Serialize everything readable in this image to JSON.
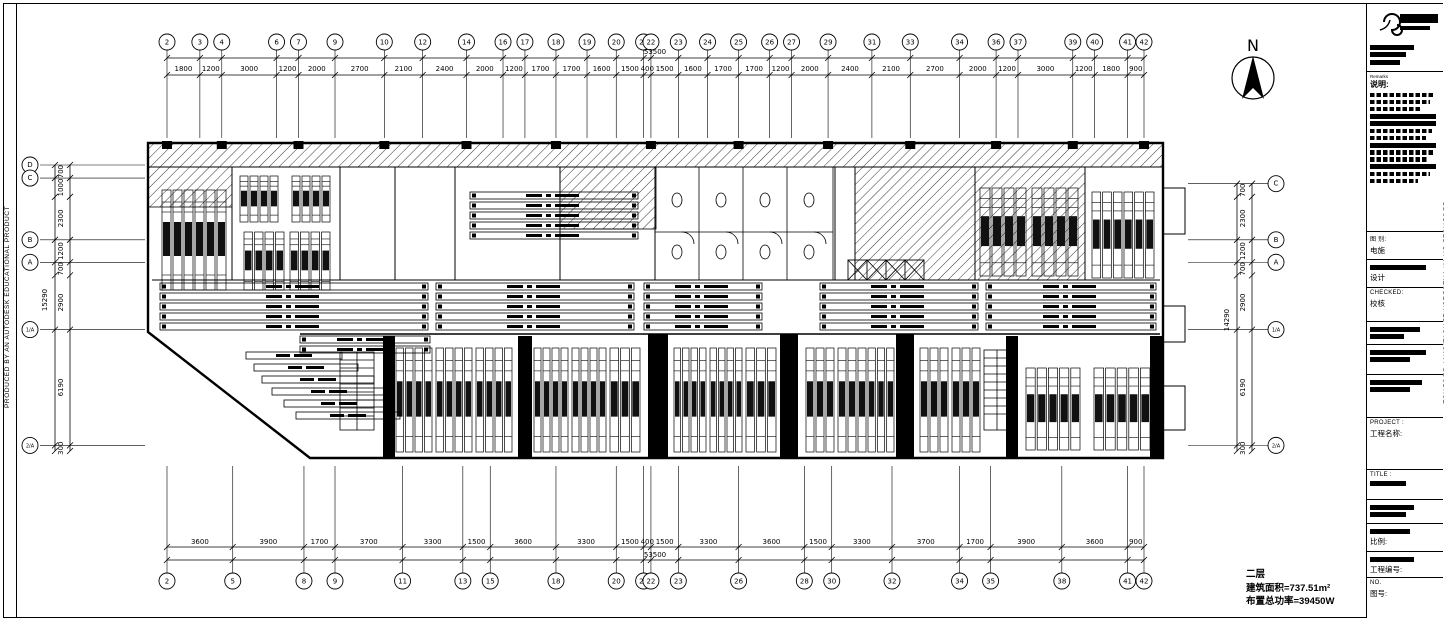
{
  "sheet": {
    "background": "#ffffff",
    "line_color": "#000000"
  },
  "north": {
    "label": "N"
  },
  "axes": {
    "top": {
      "total": "53500",
      "bubbles": [
        "2",
        "3",
        "4",
        "6",
        "7",
        "9",
        "10",
        "12",
        "14",
        "16",
        "17",
        "18",
        "19",
        "20",
        "21",
        "22",
        "23",
        "24",
        "25",
        "26",
        "27",
        "29",
        "31",
        "33",
        "34",
        "36",
        "37",
        "39",
        "40",
        "41",
        "42"
      ],
      "dims": [
        "1800",
        "1200",
        "3000",
        "1200",
        "2000",
        "2700",
        "2100",
        "2400",
        "2000",
        "1200",
        "1700",
        "1700",
        "1600",
        "1500",
        "400",
        "1500",
        "1600",
        "1700",
        "1700",
        "1200",
        "2000",
        "2400",
        "2100",
        "2700",
        "2000",
        "1200",
        "3000",
        "1200",
        "1800",
        "900"
      ]
    },
    "bottom": {
      "total": "53500",
      "bubbles": [
        "2",
        "5",
        "8",
        "9",
        "11",
        "13",
        "15",
        "18",
        "20",
        "21",
        "22",
        "23",
        "26",
        "28",
        "30",
        "32",
        "34",
        "35",
        "38",
        "41",
        "42"
      ],
      "dims": [
        "3600",
        "3900",
        "1700",
        "3700",
        "3300",
        "1500",
        "3600",
        "3300",
        "1500",
        "400",
        "1500",
        "3300",
        "3600",
        "1500",
        "3300",
        "3700",
        "1700",
        "3900",
        "3600",
        "900"
      ]
    },
    "left": {
      "total": "15290",
      "bubbles": [
        "D",
        "C",
        "B",
        "A",
        "1/A",
        "2/A"
      ],
      "bubble_at": [
        0,
        1,
        3,
        4,
        6,
        7
      ],
      "dims": [
        "700",
        "1000",
        "2300",
        "1200",
        "700",
        "2900",
        "6190",
        "300"
      ]
    },
    "right": {
      "total": "14290",
      "bubbles": [
        "C",
        "B",
        "A",
        "1/A",
        "2/A"
      ],
      "bubble_at": [
        0,
        2,
        3,
        5,
        6
      ],
      "dims": [
        "700",
        "2300",
        "1200",
        "700",
        "2900",
        "6190",
        "300"
      ]
    }
  },
  "summary": {
    "line1": "二层",
    "line2": "建筑面积=737.51m²",
    "line3": "布置总功率=39450W"
  },
  "titleblock": {
    "stamp": "PRODUCED BY AN AUTODESK EDUCATIONAL PRODUCT",
    "remarks_label": "Remarks",
    "notes_header": "说明:",
    "rows": [
      {
        "l1": "图 别:",
        "l2": "电施"
      },
      {
        "l1": "",
        "l2": "设计"
      },
      {
        "l1": "CHECKED:",
        "l2": "校核"
      },
      {
        "l1": "",
        "l2": ""
      },
      {
        "l1": "",
        "l2": ""
      },
      {
        "l1": "",
        "l2": ""
      },
      {
        "l1": "PROJECT :",
        "l2": "工程名称:"
      },
      {
        "l1": "TITLE :",
        "l2": ""
      },
      {
        "l1": "",
        "l2": ""
      },
      {
        "l1": "",
        "l2": "比例:"
      },
      {
        "l1": "",
        "l2": "工程编号:"
      },
      {
        "l1": "NO.",
        "l2": "图号:"
      }
    ]
  }
}
